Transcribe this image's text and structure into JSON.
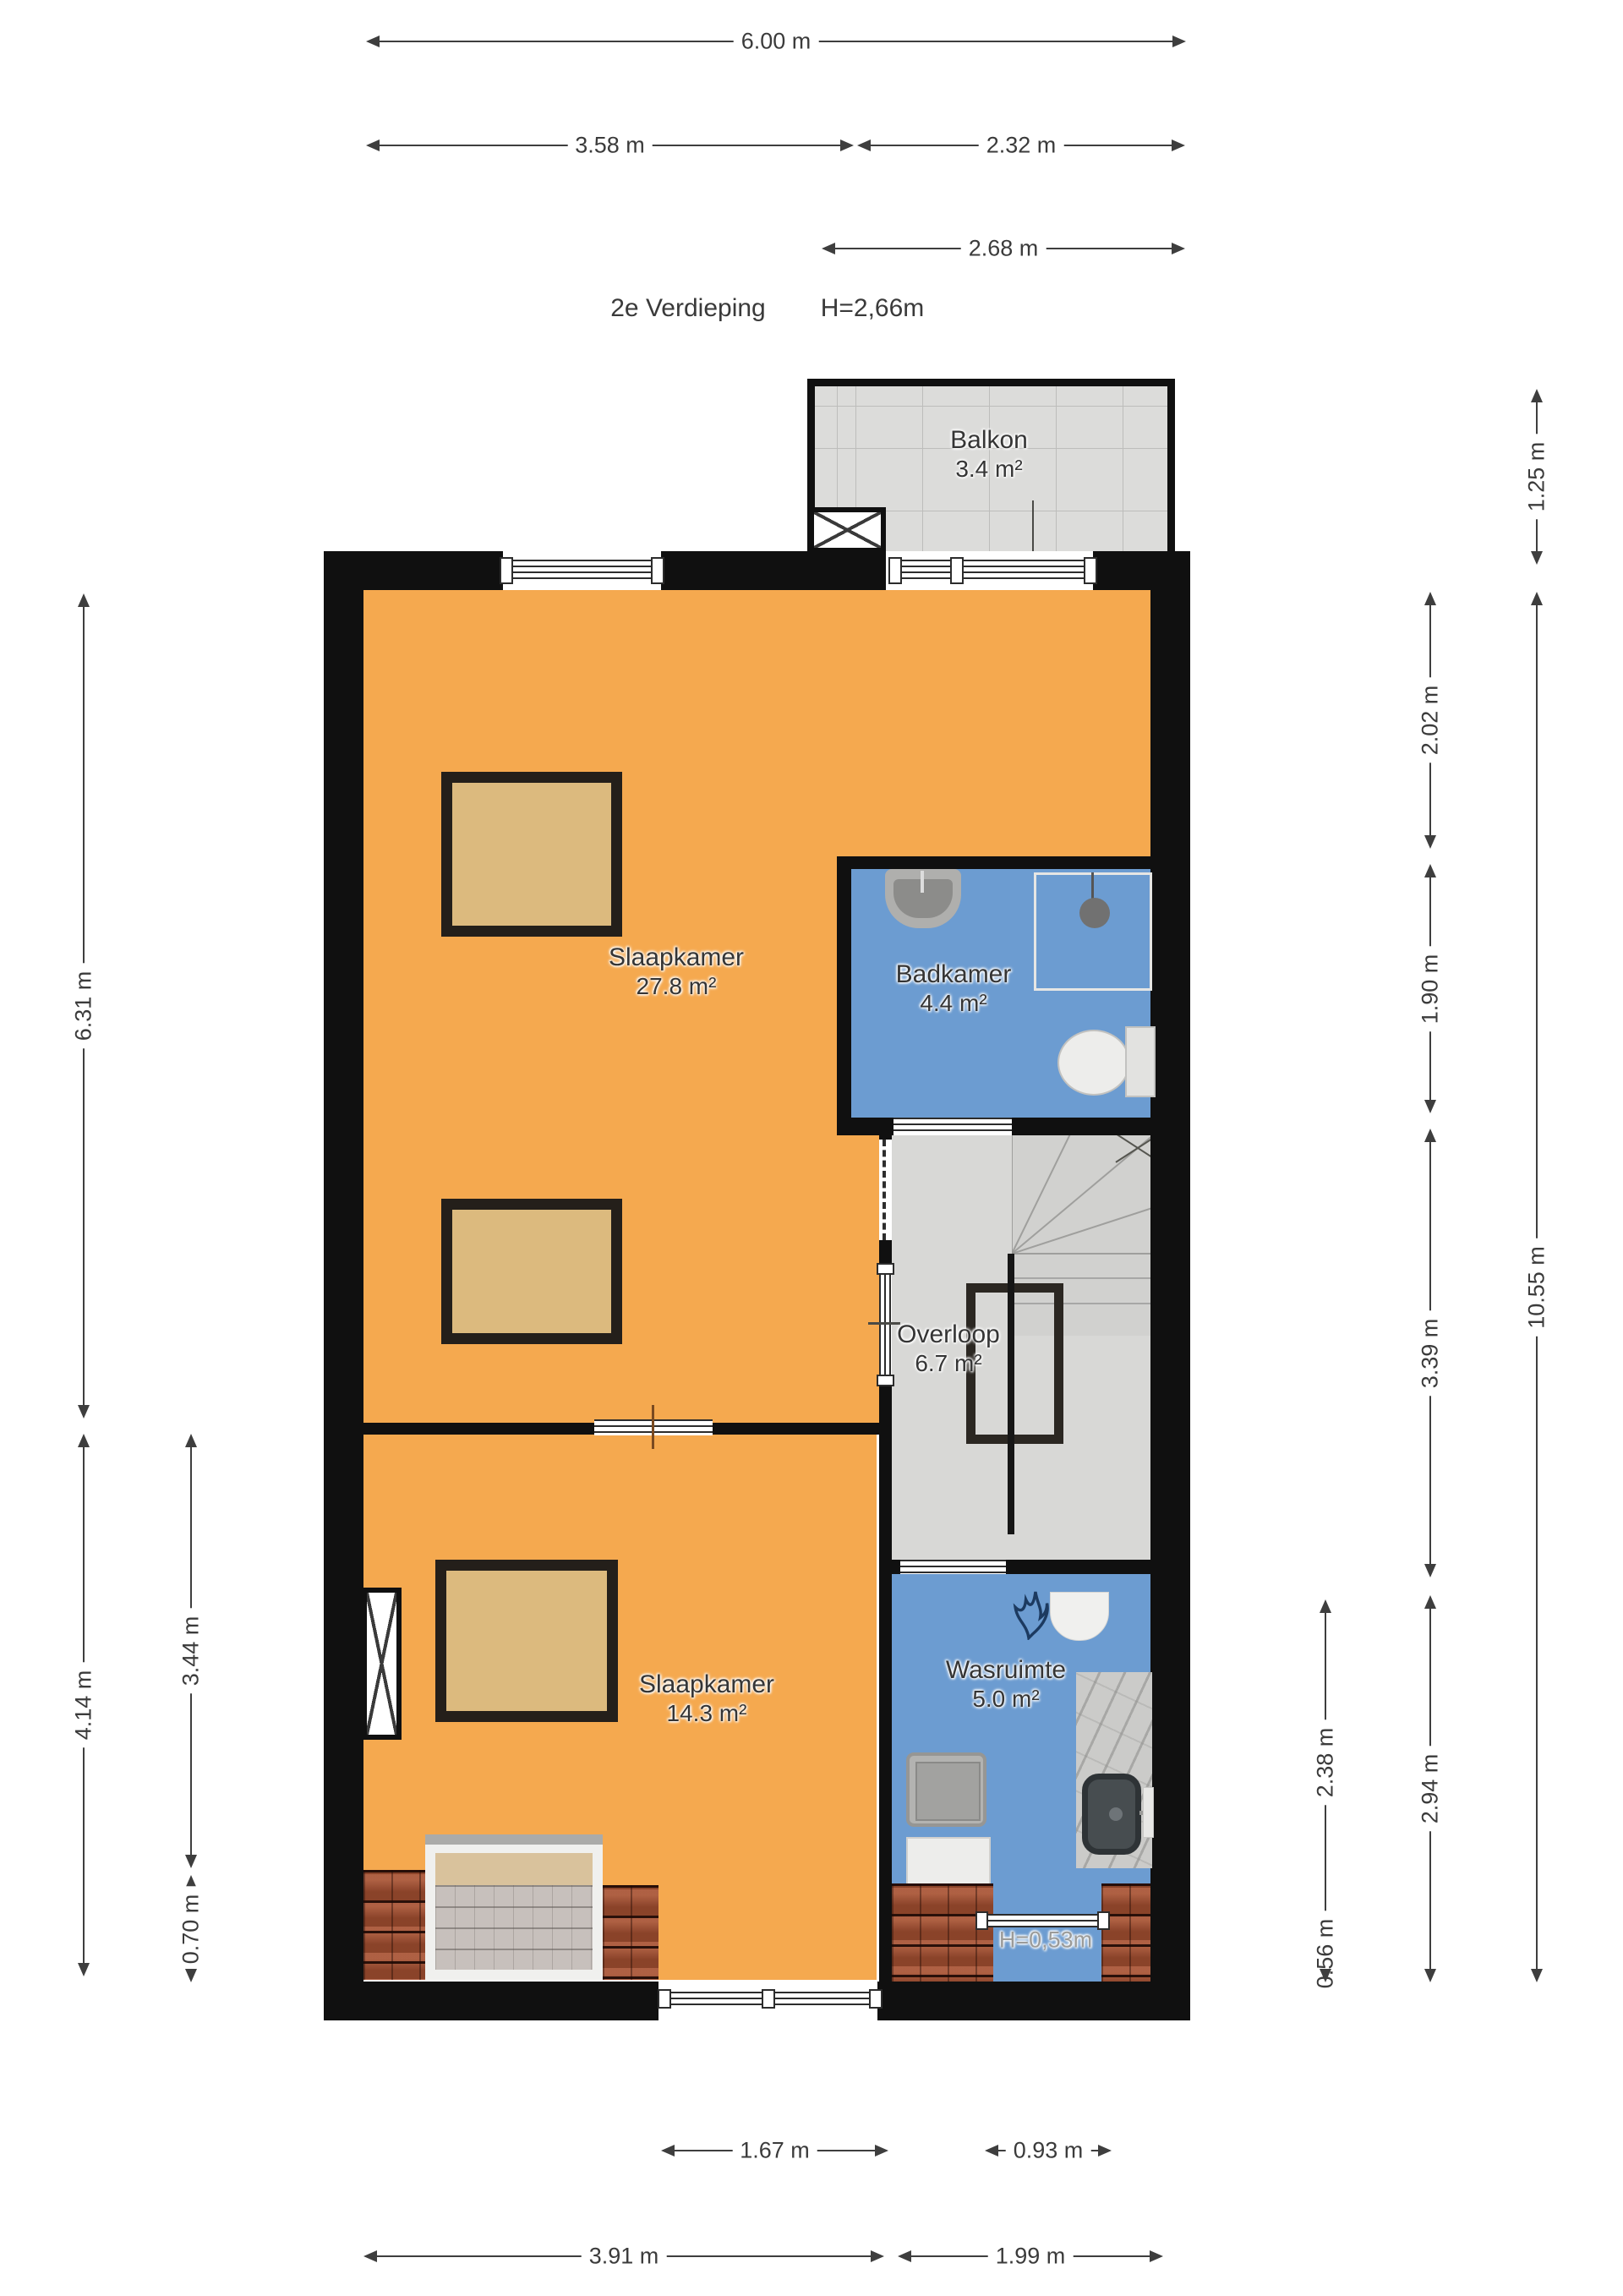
{
  "title": {
    "floor": "2e Verdieping",
    "ceiling_height": "H=2,66m"
  },
  "rooms": {
    "balkon": {
      "name": "Balkon",
      "area": "3.4 m²"
    },
    "slaapkamer1": {
      "name": "Slaapkamer",
      "area": "27.8 m²"
    },
    "badkamer": {
      "name": "Badkamer",
      "area": "4.4 m²"
    },
    "overloop": {
      "name": "Overloop",
      "area": "6.7 m²"
    },
    "slaapkamer2": {
      "name": "Slaapkamer",
      "area": "14.3 m²"
    },
    "wasruimte": {
      "name": "Wasruimte",
      "area": "5.0 m²"
    }
  },
  "annotations": {
    "low_ceiling": "H=0,53m"
  },
  "dimensions": {
    "top": [
      {
        "label": "6.00 m"
      },
      {
        "label": "3.58 m"
      },
      {
        "label": "2.32 m"
      },
      {
        "label": "2.68 m"
      }
    ],
    "left": [
      {
        "label": "6.31 m"
      },
      {
        "label": "4.14 m"
      },
      {
        "label": "3.44 m"
      },
      {
        "label": "0.70 m"
      }
    ],
    "right": [
      {
        "label": "1.25 m"
      },
      {
        "label": "2.02 m"
      },
      {
        "label": "1.90 m"
      },
      {
        "label": "3.39 m"
      },
      {
        "label": "10.55 m"
      },
      {
        "label": "2.38 m"
      },
      {
        "label": "2.94 m"
      },
      {
        "label": "0.56 m"
      }
    ],
    "bottom": [
      {
        "label": "1.67 m"
      },
      {
        "label": "0.93 m"
      },
      {
        "label": "3.91 m"
      },
      {
        "label": "1.99 m"
      }
    ]
  },
  "colors": {
    "room_orange": "#F5A94F",
    "room_blue": "#6C9CD1",
    "room_gray": "#D8D8D6",
    "wall": "#101010",
    "roof_tile": "#9D4C2F",
    "furniture_tan": "#DCBA7E",
    "dimension_text": "#3b3b3b"
  }
}
